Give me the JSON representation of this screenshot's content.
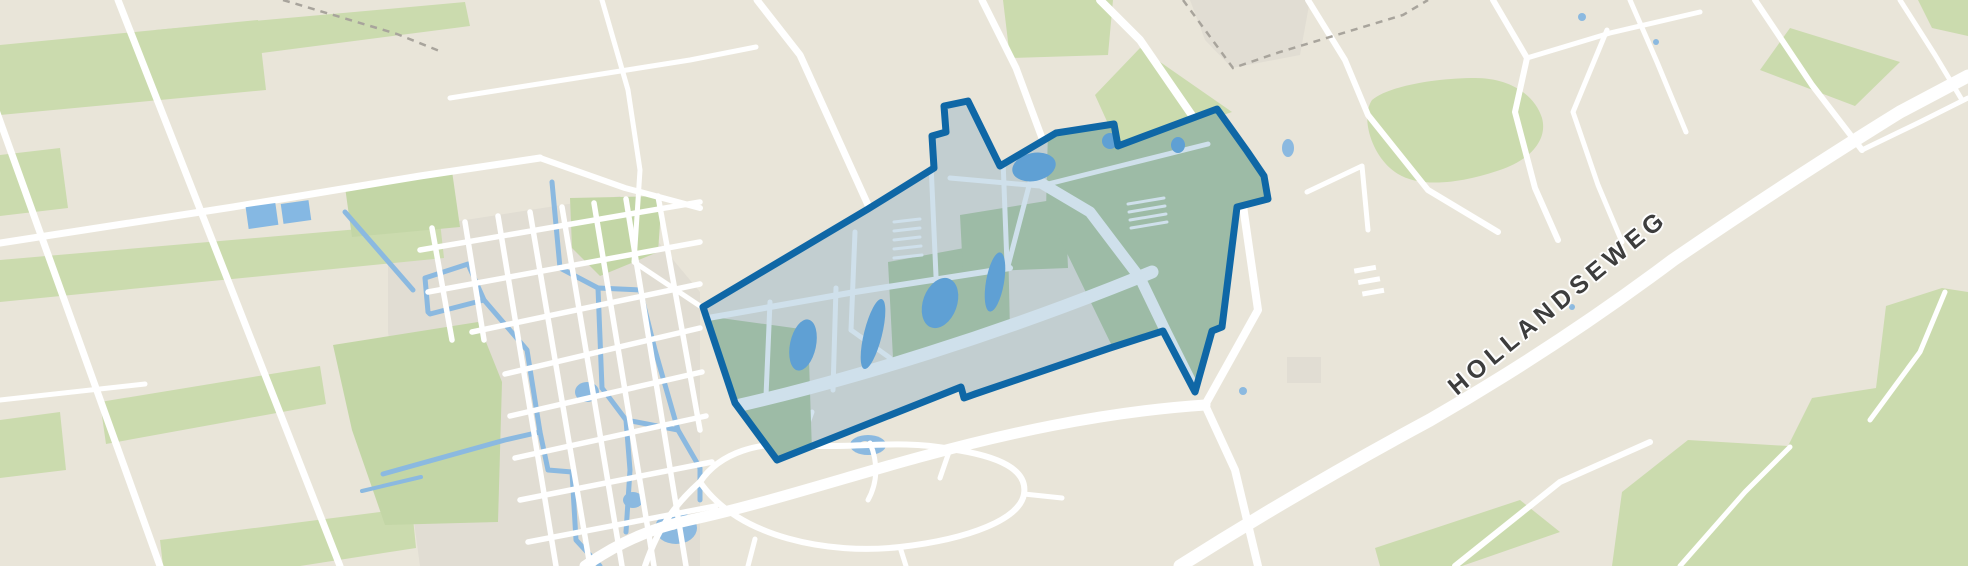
{
  "map": {
    "road_label": "HOLLANDSEWEG",
    "selection": {
      "stroke_color": "#0f67a6",
      "fill_color": "rgba(15,103,166,0.18)"
    },
    "colors": {
      "background": "#e9e5d9",
      "field_green": "#cbdbae",
      "selected_field_green": "#9dbba6",
      "water_blue": "#8bb9e0",
      "selected_pond_blue": "#5fa0d4",
      "road_white": "#ffffff",
      "selected_road_blue": "#cfe0eb",
      "built_block_gray": "#e1ddd3",
      "boundary_dash_gray": "#a8a49c"
    }
  }
}
